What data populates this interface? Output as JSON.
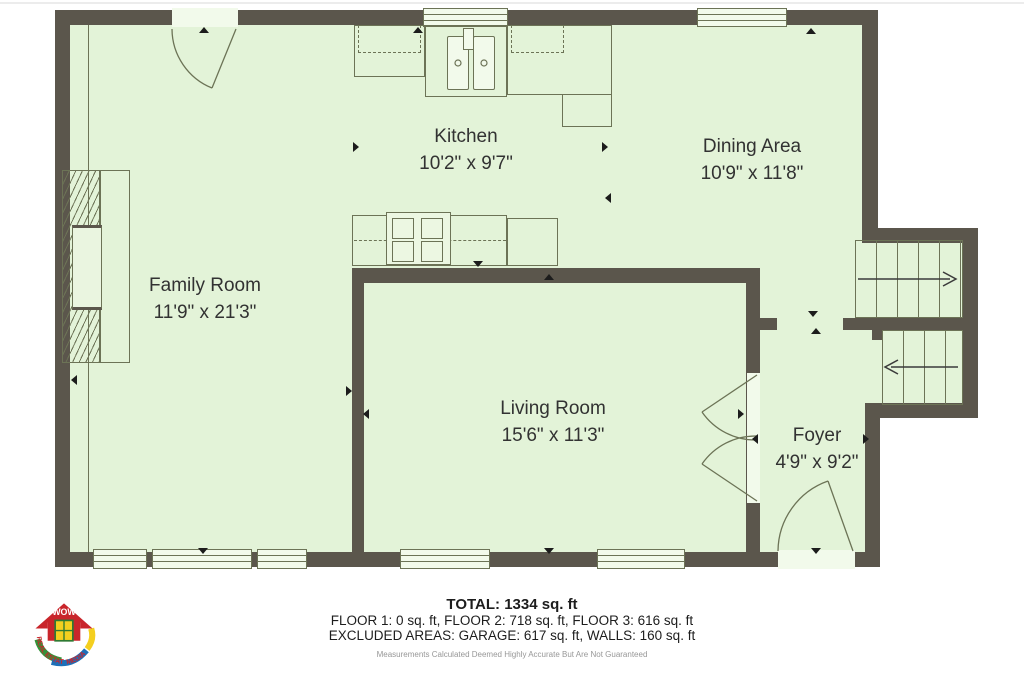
{
  "rooms": [
    {
      "name": "Kitchen",
      "dims": "10'2\" x 9'7\""
    },
    {
      "name": "Dining Area",
      "dims": "10'9\" x 11'8\""
    },
    {
      "name": "Family Room",
      "dims": "11'9\" x 21'3\""
    },
    {
      "name": "Living Room",
      "dims": "15'6\" x 11'3\""
    },
    {
      "name": "Foyer",
      "dims": "4'9\" x 9'2\""
    }
  ],
  "summary": {
    "total": "TOTAL: 1334 sq. ft",
    "floors": "FLOOR 1: 0 sq. ft, FLOOR 2: 718 sq. ft, FLOOR 3: 616 sq. ft",
    "excluded": "EXCLUDED AREAS: GARAGE: 617 sq. ft, WALLS: 160 sq. ft",
    "disclaimer": "Measurements Calculated Deemed Highly Accurate But Are Not Guaranteed"
  },
  "logo": {
    "top": "WOW",
    "left": "REAL ESTATE",
    "right": "MEDIA"
  },
  "colors": {
    "floor": "#e3f3d8",
    "wall": "#5b564c",
    "line": "#6c7356",
    "pane": "#f2faeb",
    "mark": "#1c1c1c",
    "text": "#323232"
  }
}
